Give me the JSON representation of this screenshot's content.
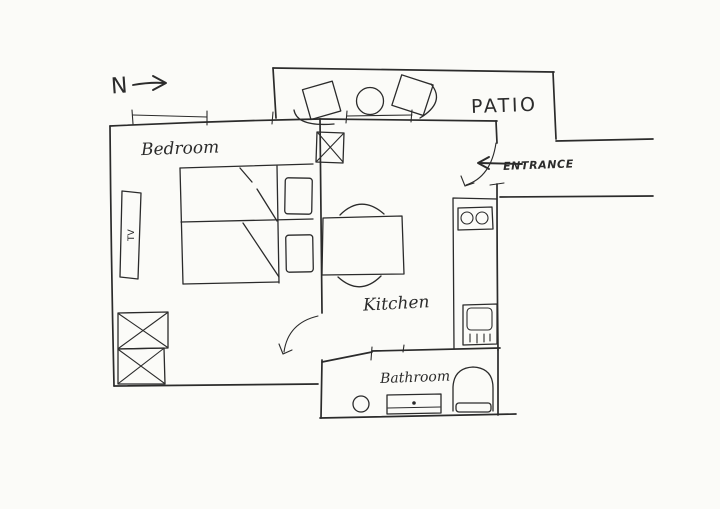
{
  "meta": {
    "title": "Hand-drawn apartment floor plan sketch"
  },
  "colors": {
    "ink": "#2b2b2b",
    "paper": "#fbfbf8"
  },
  "labels": {
    "north": "N",
    "bedroom": "Bedroom",
    "patio": "PATIO",
    "entrance": "ENTRANCE",
    "kitchen": "Kitchen",
    "bathroom": "Bathroom",
    "tv": "TV"
  },
  "rooms": [
    "Bedroom",
    "Kitchen",
    "Bathroom",
    "Patio"
  ],
  "furniture": {
    "bedroom": [
      "double-bed",
      "pillow",
      "pillow",
      "wardrobe-crossed-boxes",
      "wall-tv"
    ],
    "kitchen": [
      "dining-table",
      "chair-arc",
      "chair-arc",
      "counter",
      "stove-two-burners",
      "sink",
      "boiler-crossed-box"
    ],
    "bathroom": [
      "washbasin-circle",
      "vanity-with-drain",
      "toilet"
    ],
    "patio": [
      "armchair",
      "round-table",
      "armchair"
    ]
  },
  "annotations": [
    "north-arrow",
    "entrance-arrow",
    "entrance-door-swing",
    "bedroom-door-swing",
    "window-ticks"
  ]
}
